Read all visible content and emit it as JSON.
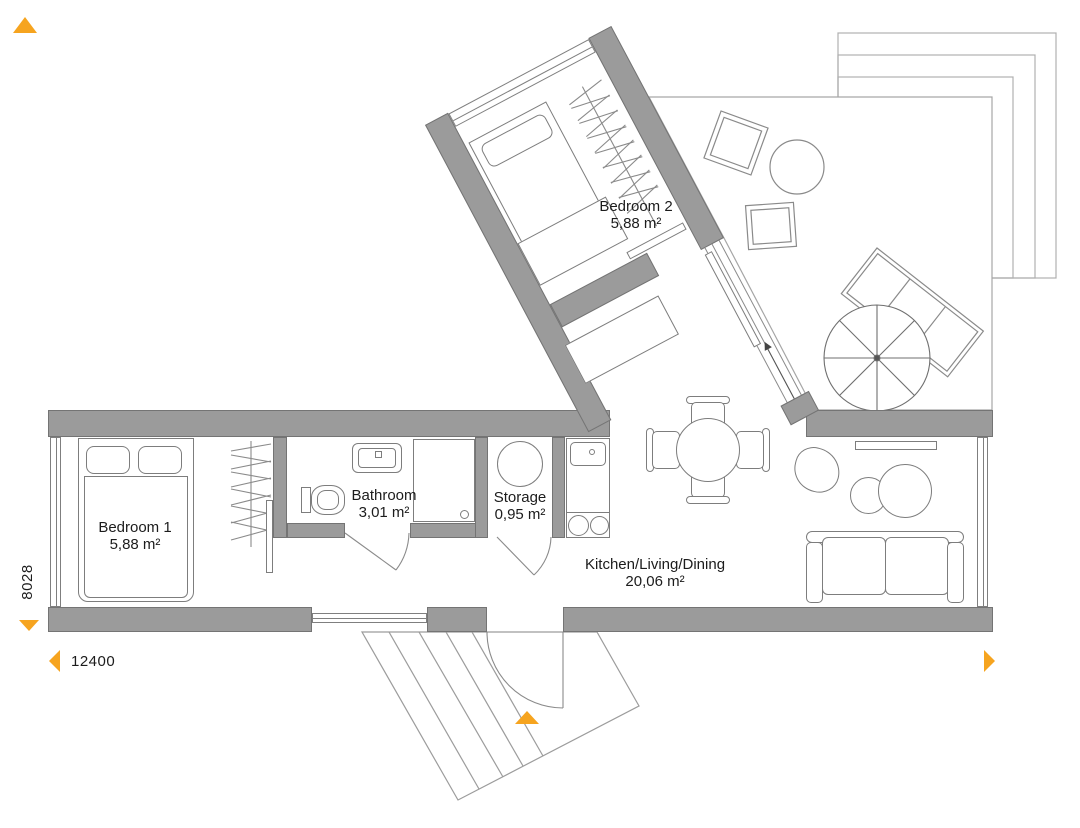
{
  "plan": {
    "rooms": [
      {
        "name": "Bedroom 2",
        "area": "5,88 m²"
      },
      {
        "name": "Bedroom 1",
        "area": "5,88 m²"
      },
      {
        "name": "Bathroom",
        "area": "3,01 m²"
      },
      {
        "name": "Storage",
        "area": "0,95 m²"
      },
      {
        "name": "Kitchen/Living/Dining",
        "area": "20,06 m²"
      }
    ],
    "dimensions": {
      "width_mm": "12400",
      "height_mm": "8028"
    },
    "colors": {
      "wall": "#9b9b9b",
      "accent_orange": "#f6a41f",
      "furniture_line": "#7d7d7d",
      "site_line": "#a6a6a6",
      "text": "#1c1c1c"
    },
    "markers": [
      {
        "icon": "north-up-triangle-icon"
      },
      {
        "icon": "extent-down-triangle-icon"
      },
      {
        "icon": "extent-left-arrow-icon"
      },
      {
        "icon": "extent-right-arrow-icon"
      },
      {
        "icon": "entrance-up-triangle-icon"
      }
    ]
  }
}
